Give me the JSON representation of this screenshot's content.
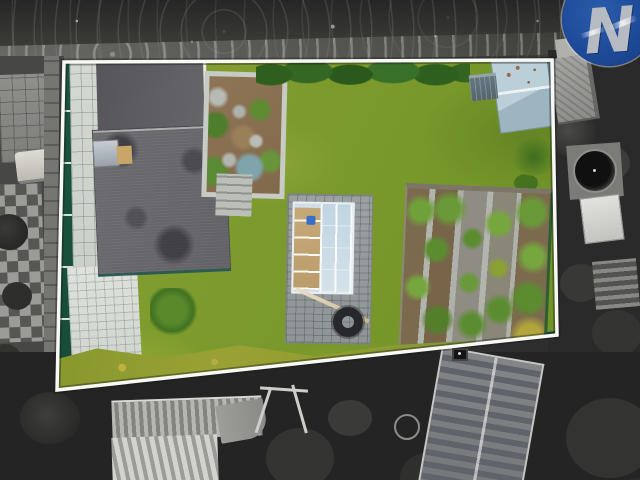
{
  "watermark": {
    "letter": "N",
    "circle_color": "#1d4a98",
    "letter_color": "#b6bac2"
  },
  "palette": {
    "lawn_green": "#7c9a2c",
    "boundary_white": "#f8f8f4",
    "fence_green": "#1b5540",
    "roof_gray": "#636368",
    "upper_roof_gray": "#5b5b5f",
    "paving_light": "#d3d8d2",
    "cobble_gray": "#959b9d",
    "soil_brown": "#8a7152",
    "veg_soil_brown": "#7c6a4e",
    "gravel_gray": "#8f8c84",
    "hedge_olive": "#9aa134",
    "shed_blue_gray": "#bacfd8",
    "cold_frame_glass": "#cfdfe8",
    "surroundings_grayscale_base": "#2e2e2e"
  }
}
